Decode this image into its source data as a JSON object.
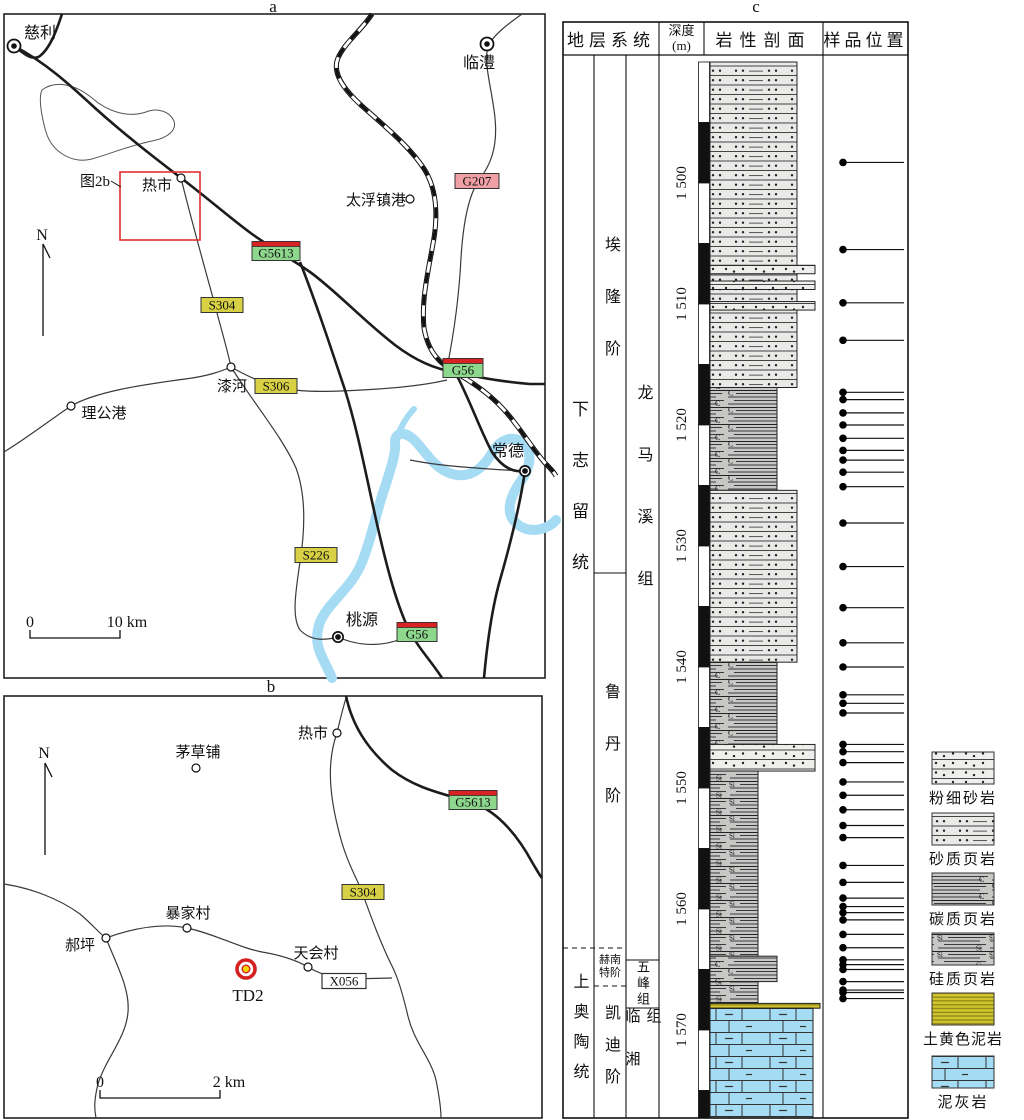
{
  "figure": {
    "panel_a_label": "a",
    "panel_b_label": "b",
    "panel_c_label": "c"
  },
  "colors": {
    "expressway_green": "#8ed88e",
    "expressway_red": "#d92222",
    "national_pink": "#f0a0a4",
    "provincial_yellow": "#d8d145",
    "county_white": "#ffffff",
    "river_blue": "#a6dbf4",
    "inset_red": "#e03030",
    "well_red": "#d42020",
    "well_yellow": "#f2d800"
  },
  "map_a": {
    "north_label": "N",
    "inset_label": "图2b",
    "cities": [
      {
        "name": "慈利"
      },
      {
        "name": "临澧"
      },
      {
        "name": "常德"
      },
      {
        "name": "桃源"
      }
    ],
    "towns": [
      {
        "name": "热市"
      },
      {
        "name": "太浮镇港"
      },
      {
        "name": "漆河"
      },
      {
        "name": "理公港"
      }
    ],
    "road_labels": [
      {
        "code": "G207",
        "class": "national"
      },
      {
        "code": "G5613",
        "class": "expressway"
      },
      {
        "code": "S304",
        "class": "provincial"
      },
      {
        "code": "S306",
        "class": "provincial"
      },
      {
        "code": "G56",
        "class": "expressway"
      },
      {
        "code": "S226",
        "class": "provincial"
      },
      {
        "code": "G56",
        "class": "expressway"
      }
    ],
    "scale": {
      "zero": "0",
      "label": "10 km"
    }
  },
  "map_b": {
    "north_label": "N",
    "towns": [
      {
        "name": "热市"
      },
      {
        "name": "茅草铺"
      },
      {
        "name": "暴家村"
      },
      {
        "name": "郝坪"
      },
      {
        "name": "天会村"
      }
    ],
    "road_labels": [
      {
        "code": "G5613",
        "class": "expressway"
      },
      {
        "code": "S304",
        "class": "provincial"
      },
      {
        "code": "X056",
        "class": "county"
      }
    ],
    "well": {
      "name": "TD2"
    },
    "scale": {
      "zero": "0",
      "label": "2 km"
    }
  },
  "column": {
    "headers": {
      "strat": "地层系统",
      "depth": "深度",
      "depth_unit": "(m)",
      "lithology": "岩性剖面",
      "samples": "样品位置"
    },
    "series": [
      {
        "name": "下志留统",
        "top": 1490.0,
        "base": 1563.2
      },
      {
        "name": "上奥陶统",
        "top": 1563.2,
        "base": 1577.3
      }
    ],
    "stages": [
      {
        "name": "埃隆阶",
        "top": 1490.0,
        "base": 1532.2
      },
      {
        "name": "鲁丹阶",
        "top": 1532.2,
        "base": 1563.2
      },
      {
        "name": "赫南特阶",
        "row1": "赫南",
        "row2": "特阶",
        "top": 1563.2,
        "base": 1566.4
      },
      {
        "name": "凯迪阶",
        "top": 1566.4,
        "base": 1577.3
      }
    ],
    "formations": [
      {
        "name": "龙马溪组",
        "top": 1490.0,
        "base": 1564.2
      },
      {
        "name": "五峰组",
        "top": 1564.2,
        "base": 1568.2
      },
      {
        "name": "临湘组",
        "top": 1568.2,
        "base": 1577.3
      }
    ],
    "depth_scale": {
      "top_depth": 1490,
      "bottom_depth": 1577.3,
      "top_y": 62,
      "bottom_y": 1118,
      "px_per_m": 12.1
    },
    "depth_ticks": [
      {
        "value": 1500,
        "label": "1 500"
      },
      {
        "value": 1510,
        "label": "1 510"
      },
      {
        "value": 1520,
        "label": "1 520"
      },
      {
        "value": 1530,
        "label": "1 530"
      },
      {
        "value": 1540,
        "label": "1 540"
      },
      {
        "value": 1550,
        "label": "1 550"
      },
      {
        "value": 1560,
        "label": "1 560"
      },
      {
        "value": 1570,
        "label": "1 570"
      }
    ],
    "beds": [
      {
        "lithology": "sandy_shale",
        "top": 1490.0,
        "base": 1516.9
      },
      {
        "lithology": "fine_sandstone",
        "top": 1506.8,
        "base": 1507.5
      },
      {
        "lithology": "fine_sandstone",
        "top": 1508.1,
        "base": 1508.8
      },
      {
        "lithology": "fine_sandstone",
        "top": 1509.8,
        "base": 1510.5
      },
      {
        "lithology": "carbonaceous_shale",
        "top": 1516.9,
        "base": 1525.4
      },
      {
        "lithology": "sandy_shale",
        "top": 1525.4,
        "base": 1539.6
      },
      {
        "lithology": "carbonaceous_shale",
        "top": 1539.6,
        "base": 1546.4
      },
      {
        "lithology": "fine_sandstone",
        "top": 1546.4,
        "base": 1548.6
      },
      {
        "lithology": "siliceous_shale",
        "top": 1548.6,
        "base": 1563.9
      },
      {
        "lithology": "carbonaceous_shale",
        "top": 1563.9,
        "base": 1566.0
      },
      {
        "lithology": "siliceous_shale",
        "top": 1566.0,
        "base": 1567.8
      },
      {
        "lithology": "yellow_mudstone",
        "top": 1567.8,
        "base": 1568.2
      },
      {
        "lithology": "marl",
        "top": 1568.2,
        "base": 1577.3
      }
    ],
    "samples": [
      1498.3,
      1505.5,
      1509.9,
      1513.0,
      1517.3,
      1517.9,
      1519.0,
      1520.0,
      1521.1,
      1522.1,
      1522.9,
      1523.9,
      1525.1,
      1528.1,
      1531.7,
      1535.1,
      1538.0,
      1540.0,
      1542.3,
      1543.0,
      1543.8,
      1546.4,
      1547.0,
      1547.9,
      1549.5,
      1550.6,
      1551.8,
      1553.1,
      1554.1,
      1556.4,
      1557.8,
      1559.1,
      1559.8,
      1560.3,
      1560.9,
      1562.1,
      1563.2,
      1564.2,
      1564.6,
      1565.0,
      1566.0,
      1566.7,
      1566.9,
      1567.4
    ],
    "legend": [
      {
        "lithology": "fine_sandstone",
        "label": "粉细砂岩"
      },
      {
        "lithology": "sandy_shale",
        "label": "砂质页岩"
      },
      {
        "lithology": "carbonaceous_shale",
        "label": "碳质页岩"
      },
      {
        "lithology": "siliceous_shale",
        "label": "硅质页岩"
      },
      {
        "lithology": "yellow_mudstone",
        "label": "土黄色泥岩"
      },
      {
        "lithology": "marl",
        "label": "泥灰岩"
      }
    ]
  }
}
